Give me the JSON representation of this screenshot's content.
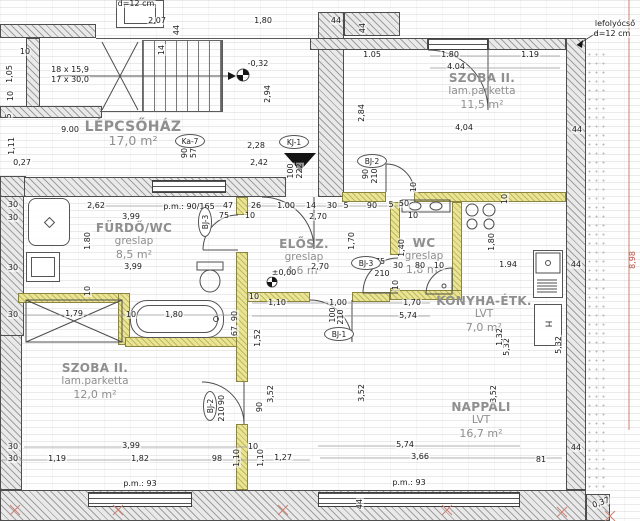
{
  "title": "Lakás alaprajz (apartment floor plan)",
  "fridge_label": "H",
  "colors": {
    "partition_wall_yellow": "#eae593",
    "structural_wall_gray": "#e9e9e9",
    "hatch_line": "#9f9f9f",
    "dim_text": "#1c1c1c",
    "room_label_gray": "#8f8f8f",
    "red_mark": "#c77b6e"
  },
  "rooms": [
    {
      "name": "LÉPCSŐHÁZ",
      "material": "",
      "area": "17,0 m²",
      "x": 133,
      "y": 121,
      "big": true
    },
    {
      "name": "SZOBA II.",
      "material": "lam.parketta",
      "area": "11,5 m²",
      "x": 482,
      "y": 72,
      "big": false
    },
    {
      "name": "FÜRDŐ/WC",
      "material": "greslap",
      "area": "8,5 m²",
      "x": 134,
      "y": 222,
      "big": false
    },
    {
      "name": "ELŐSZ.",
      "material": "greslap",
      "area": "4,6 m²",
      "x": 304,
      "y": 238,
      "big": false
    },
    {
      "name": "WC",
      "material": "greslap",
      "area": "1,8 m²",
      "x": 424,
      "y": 237,
      "big": false
    },
    {
      "name": "KONYHA-ÉTK.",
      "material": "LVT",
      "area": "7,0 m²",
      "x": 484,
      "y": 295,
      "big": false
    },
    {
      "name": "SZOBA II.",
      "material": "lam.parketta",
      "area": "12,0 m²",
      "x": 95,
      "y": 362,
      "big": false
    },
    {
      "name": "NAPPALI",
      "material": "LVT",
      "area": "16,7 m²",
      "x": 481,
      "y": 401,
      "big": false
    }
  ],
  "door_tags": [
    {
      "label": "Ka-7",
      "x": 190,
      "y": 141,
      "r": 0
    },
    {
      "label": "KJ-1",
      "x": 294,
      "y": 142,
      "r": 0
    },
    {
      "label": "BJ-2",
      "x": 372,
      "y": 161,
      "r": 0
    },
    {
      "label": "BJ-3",
      "x": 205,
      "y": 222,
      "r": -90
    },
    {
      "label": "BJ-3",
      "x": 366,
      "y": 263,
      "r": 0
    },
    {
      "label": "BJ-1",
      "x": 339,
      "y": 334,
      "r": 0
    },
    {
      "label": "BJ-2",
      "x": 210,
      "y": 406,
      "r": -90
    }
  ],
  "annotations": [
    {
      "t": "d=12 cm",
      "x": 136,
      "y": 4
    },
    {
      "t": "2,07",
      "x": 157,
      "y": 21
    },
    {
      "t": "44",
      "x": 177,
      "y": 30,
      "r": -90
    },
    {
      "t": "14",
      "x": 162,
      "y": 50,
      "r": -90
    },
    {
      "t": "10",
      "x": 25,
      "y": 52
    },
    {
      "t": "18 x 15,9",
      "x": 70,
      "y": 70
    },
    {
      "t": "17 x 30,0",
      "x": 70,
      "y": 80
    },
    {
      "t": "1,05",
      "x": 10,
      "y": 74,
      "r": -90
    },
    {
      "t": "10",
      "x": 11,
      "y": 96,
      "r": -90
    },
    {
      "t": "5",
      "x": 9,
      "y": 116,
      "r": -90
    },
    {
      "t": "9.00",
      "x": 70,
      "y": 130
    },
    {
      "t": "1,11",
      "x": 12,
      "y": 146,
      "r": -90
    },
    {
      "t": "0,27",
      "x": 22,
      "y": 163
    },
    {
      "t": "90",
      "x": 185,
      "y": 153,
      "r": -90
    },
    {
      "t": "57",
      "x": 194,
      "y": 153,
      "r": -90
    },
    {
      "t": "1,80",
      "x": 263,
      "y": 21
    },
    {
      "t": "44",
      "x": 336,
      "y": 21
    },
    {
      "t": "44",
      "x": 363,
      "y": 28,
      "r": -90
    },
    {
      "t": "-0,32",
      "x": 258,
      "y": 64
    },
    {
      "t": "2,94",
      "x": 268,
      "y": 94,
      "r": -90
    },
    {
      "t": "2,28",
      "x": 256,
      "y": 146
    },
    {
      "t": "2,42",
      "x": 259,
      "y": 163
    },
    {
      "t": "100",
      "x": 291,
      "y": 171,
      "r": -90
    },
    {
      "t": "222",
      "x": 300,
      "y": 171,
      "r": -90
    },
    {
      "t": "1.05",
      "x": 372,
      "y": 55
    },
    {
      "t": "1.80",
      "x": 450,
      "y": 55
    },
    {
      "t": "1.19",
      "x": 530,
      "y": 55
    },
    {
      "t": "4.04",
      "x": 456,
      "y": 67
    },
    {
      "t": "4,04",
      "x": 464,
      "y": 128
    },
    {
      "t": "44",
      "x": 577,
      "y": 130
    },
    {
      "t": "lefolyócső",
      "x": 615,
      "y": 24
    },
    {
      "t": "d=12 cm",
      "x": 612,
      "y": 34
    },
    {
      "t": "90",
      "x": 366,
      "y": 174,
      "r": -90
    },
    {
      "t": "210",
      "x": 375,
      "y": 176,
      "r": -90
    },
    {
      "t": "2,84",
      "x": 362,
      "y": 113,
      "r": -90
    },
    {
      "t": "2,62",
      "x": 96,
      "y": 206
    },
    {
      "t": "3,99",
      "x": 131,
      "y": 217
    },
    {
      "t": "p.m.: 90/165",
      "x": 189,
      "y": 207
    },
    {
      "t": "47",
      "x": 228,
      "y": 206
    },
    {
      "t": "26",
      "x": 256,
      "y": 206
    },
    {
      "t": "75",
      "x": 224,
      "y": 216
    },
    {
      "t": "10",
      "x": 250,
      "y": 216
    },
    {
      "t": "1.00",
      "x": 286,
      "y": 206
    },
    {
      "t": "14",
      "x": 311,
      "y": 206
    },
    {
      "t": "30",
      "x": 332,
      "y": 206
    },
    {
      "t": "5",
      "x": 346,
      "y": 206
    },
    {
      "t": "2,70",
      "x": 318,
      "y": 217
    },
    {
      "t": "90",
      "x": 372,
      "y": 206
    },
    {
      "t": "5",
      "x": 391,
      "y": 205
    },
    {
      "t": "50",
      "x": 404,
      "y": 204
    },
    {
      "t": "10",
      "x": 413,
      "y": 216
    },
    {
      "t": "10",
      "x": 414,
      "y": 187,
      "r": -90
    },
    {
      "t": "10",
      "x": 505,
      "y": 199,
      "r": -90
    },
    {
      "t": "30",
      "x": 13,
      "y": 205
    },
    {
      "t": "30",
      "x": 13,
      "y": 218
    },
    {
      "t": "30",
      "x": 13,
      "y": 268
    },
    {
      "t": "30",
      "x": 13,
      "y": 315
    },
    {
      "t": "1.80",
      "x": 88,
      "y": 241,
      "r": -90
    },
    {
      "t": "3,99",
      "x": 133,
      "y": 267
    },
    {
      "t": "10",
      "x": 88,
      "y": 291,
      "r": -90
    },
    {
      "t": "1,79",
      "x": 74,
      "y": 314
    },
    {
      "t": "10",
      "x": 131,
      "y": 315
    },
    {
      "t": "1,80",
      "x": 174,
      "y": 315
    },
    {
      "t": "90",
      "x": 235,
      "y": 316,
      "r": -90
    },
    {
      "t": "67",
      "x": 235,
      "y": 331,
      "r": -90
    },
    {
      "t": "2,70",
      "x": 320,
      "y": 267
    },
    {
      "t": "1,70",
      "x": 352,
      "y": 241,
      "r": -90
    },
    {
      "t": "75",
      "x": 380,
      "y": 262
    },
    {
      "t": "210",
      "x": 382,
      "y": 274
    },
    {
      "t": "±0,00",
      "x": 284,
      "y": 273
    },
    {
      "t": "10",
      "x": 254,
      "y": 297
    },
    {
      "t": "1,10",
      "x": 277,
      "y": 303
    },
    {
      "t": "1,00",
      "x": 338,
      "y": 303
    },
    {
      "t": "1,70",
      "x": 412,
      "y": 303
    },
    {
      "t": "5,74",
      "x": 408,
      "y": 316
    },
    {
      "t": "100",
      "x": 333,
      "y": 315,
      "r": -90
    },
    {
      "t": "210",
      "x": 341,
      "y": 317,
      "r": -90
    },
    {
      "t": "1,52",
      "x": 258,
      "y": 338,
      "r": -90
    },
    {
      "t": "1,40",
      "x": 402,
      "y": 248,
      "r": -90
    },
    {
      "t": "30",
      "x": 398,
      "y": 266
    },
    {
      "t": "80",
      "x": 420,
      "y": 266
    },
    {
      "t": "10",
      "x": 439,
      "y": 266
    },
    {
      "t": "10",
      "x": 396,
      "y": 285,
      "r": -90
    },
    {
      "t": "1,80",
      "x": 492,
      "y": 242,
      "r": -90
    },
    {
      "t": "1.94",
      "x": 508,
      "y": 265
    },
    {
      "t": "44",
      "x": 576,
      "y": 265
    },
    {
      "t": "5,32",
      "x": 507,
      "y": 347,
      "r": -90
    },
    {
      "t": "5,32",
      "x": 559,
      "y": 345,
      "r": -90
    },
    {
      "t": "1,32",
      "x": 500,
      "y": 337,
      "r": -90
    },
    {
      "t": "3,52",
      "x": 271,
      "y": 394,
      "r": -90
    },
    {
      "t": "3,52",
      "x": 362,
      "y": 393,
      "r": -90
    },
    {
      "t": "3,52",
      "x": 494,
      "y": 394,
      "r": -90
    },
    {
      "t": "90",
      "x": 260,
      "y": 407,
      "r": -90
    },
    {
      "t": "90",
      "x": 222,
      "y": 400,
      "r": -90
    },
    {
      "t": "210",
      "x": 222,
      "y": 414,
      "r": -90
    },
    {
      "t": "30",
      "x": 13,
      "y": 447
    },
    {
      "t": "3,99",
      "x": 131,
      "y": 446
    },
    {
      "t": "10",
      "x": 253,
      "y": 447
    },
    {
      "t": "30",
      "x": 13,
      "y": 459
    },
    {
      "t": "1,19",
      "x": 57,
      "y": 459
    },
    {
      "t": "1,82",
      "x": 140,
      "y": 459
    },
    {
      "t": "98",
      "x": 217,
      "y": 459
    },
    {
      "t": "1,10",
      "x": 237,
      "y": 458,
      "r": -90
    },
    {
      "t": "1,10",
      "x": 261,
      "y": 458,
      "r": -90
    },
    {
      "t": "1,27",
      "x": 283,
      "y": 458
    },
    {
      "t": "5,74",
      "x": 405,
      "y": 445
    },
    {
      "t": "3,66",
      "x": 420,
      "y": 457
    },
    {
      "t": "p.m.: 93",
      "x": 140,
      "y": 484
    },
    {
      "t": "p.m.: 93",
      "x": 409,
      "y": 483
    },
    {
      "t": "44",
      "x": 360,
      "y": 504,
      "r": -90
    },
    {
      "t": "44",
      "x": 576,
      "y": 448
    },
    {
      "t": "81",
      "x": 541,
      "y": 460
    },
    {
      "t": "0,37",
      "x": 601,
      "y": 503,
      "r": -20
    },
    {
      "t": "8,98",
      "x": 633,
      "y": 260,
      "r": -90,
      "c": "red"
    }
  ]
}
